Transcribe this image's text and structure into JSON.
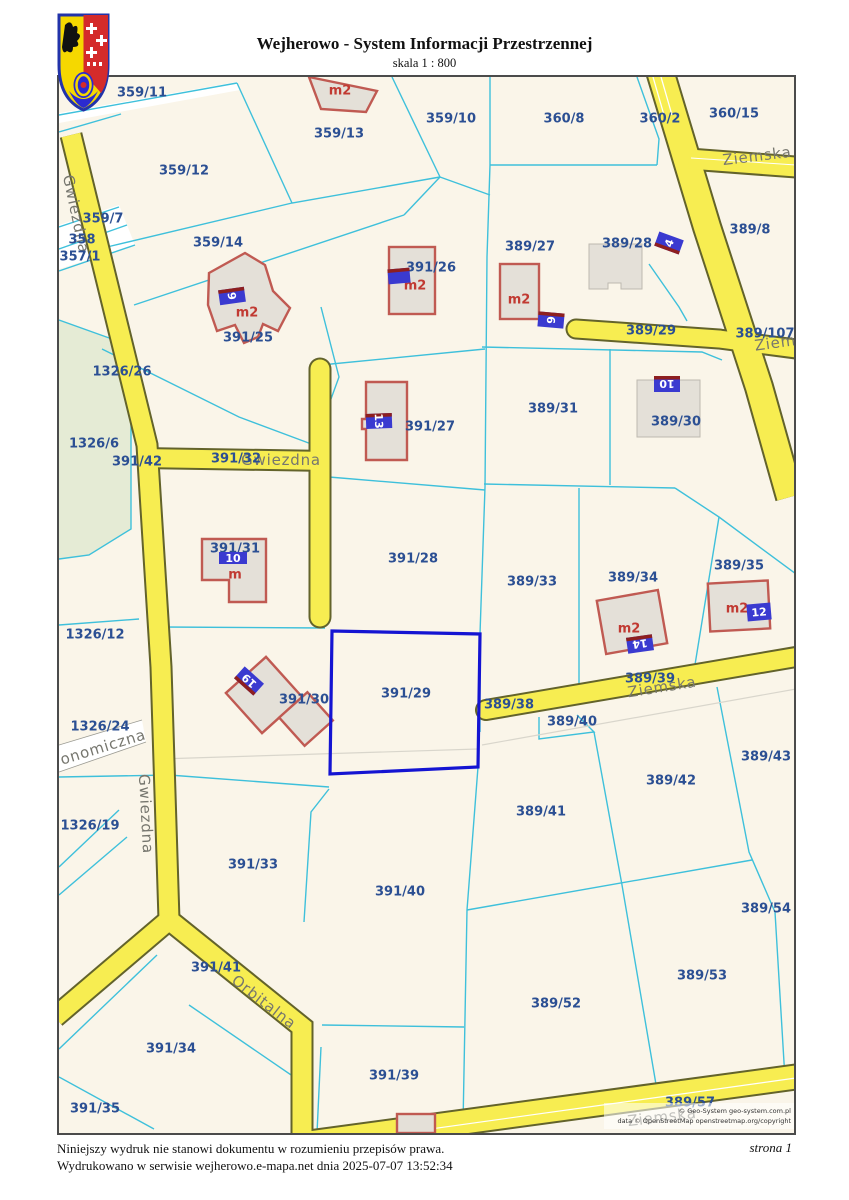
{
  "header": {
    "title": "Wejherowo - System Informacji Przestrzennej",
    "scale": "skala 1 : 800"
  },
  "footer": {
    "disclaimer": "Niniejszy wydruk nie stanowi dokumentu w rozumieniu przepisów prawa.",
    "printed": "Wydrukowano w serwisie wejherowo.e-mapa.net dnia 2025-07-07 13:52:34",
    "page": "strona 1"
  },
  "map": {
    "highlighted_parcel": "391/29",
    "copyright": [
      "© Geo-System geo-system.com.pl",
      "data © OpenStreetMap openstreetmap.org/copyright"
    ],
    "parcel_labels": [
      {
        "t": "359/11",
        "x": 83,
        "y": 15
      },
      {
        "t": "359/13",
        "x": 280,
        "y": 56
      },
      {
        "t": "359/10",
        "x": 392,
        "y": 41
      },
      {
        "t": "360/8",
        "x": 505,
        "y": 41
      },
      {
        "t": "360/2",
        "x": 601,
        "y": 41
      },
      {
        "t": "360/15",
        "x": 675,
        "y": 36
      },
      {
        "t": "359/12",
        "x": 125,
        "y": 93
      },
      {
        "t": "359/7",
        "x": 44,
        "y": 141
      },
      {
        "t": "358",
        "x": 23,
        "y": 162
      },
      {
        "t": "357/1",
        "x": 21,
        "y": 179
      },
      {
        "t": "359/14",
        "x": 159,
        "y": 165
      },
      {
        "t": "389/27",
        "x": 471,
        "y": 169
      },
      {
        "t": "389/28",
        "x": 568,
        "y": 166
      },
      {
        "t": "389/8",
        "x": 691,
        "y": 152
      },
      {
        "t": "391/26",
        "x": 372,
        "y": 190
      },
      {
        "t": "389/29",
        "x": 592,
        "y": 253
      },
      {
        "t": "389/107",
        "x": 706,
        "y": 256
      },
      {
        "t": "391/25",
        "x": 189,
        "y": 260
      },
      {
        "t": "1326/26",
        "x": 63,
        "y": 294
      },
      {
        "t": "389/31",
        "x": 494,
        "y": 331
      },
      {
        "t": "389/30",
        "x": 617,
        "y": 344
      },
      {
        "t": "391/27",
        "x": 371,
        "y": 349
      },
      {
        "t": "1326/6",
        "x": 35,
        "y": 366
      },
      {
        "t": "391/32",
        "x": 177,
        "y": 381
      },
      {
        "t": "391/42",
        "x": 78,
        "y": 384
      },
      {
        "t": "391/31",
        "x": 176,
        "y": 471
      },
      {
        "t": "391/28",
        "x": 354,
        "y": 481
      },
      {
        "t": "389/33",
        "x": 473,
        "y": 504
      },
      {
        "t": "389/34",
        "x": 574,
        "y": 500
      },
      {
        "t": "389/35",
        "x": 680,
        "y": 488
      },
      {
        "t": "1326/12",
        "x": 36,
        "y": 557
      },
      {
        "t": "391/30",
        "x": 245,
        "y": 622
      },
      {
        "t": "391/29",
        "x": 347,
        "y": 616
      },
      {
        "t": "389/38",
        "x": 450,
        "y": 627
      },
      {
        "t": "389/39",
        "x": 591,
        "y": 601
      },
      {
        "t": "389/40",
        "x": 513,
        "y": 644
      },
      {
        "t": "1326/24",
        "x": 41,
        "y": 649
      },
      {
        "t": "389/43",
        "x": 707,
        "y": 679
      },
      {
        "t": "389/42",
        "x": 612,
        "y": 703
      },
      {
        "t": "389/41",
        "x": 482,
        "y": 734
      },
      {
        "t": "1326/19",
        "x": 31,
        "y": 748
      },
      {
        "t": "391/33",
        "x": 194,
        "y": 787
      },
      {
        "t": "391/40",
        "x": 341,
        "y": 814
      },
      {
        "t": "389/54",
        "x": 707,
        "y": 831
      },
      {
        "t": "391/41",
        "x": 157,
        "y": 890
      },
      {
        "t": "389/53",
        "x": 643,
        "y": 898
      },
      {
        "t": "389/52",
        "x": 497,
        "y": 926
      },
      {
        "t": "391/34",
        "x": 112,
        "y": 971
      },
      {
        "t": "391/39",
        "x": 335,
        "y": 998
      },
      {
        "t": "391/35",
        "x": 36,
        "y": 1031
      },
      {
        "t": "389/57",
        "x": 631,
        "y": 1025
      }
    ],
    "street_labels": [
      {
        "t": "Ziemska",
        "x": 698,
        "y": 79,
        "r": -7
      },
      {
        "t": "Ziemska",
        "x": 730,
        "y": 264,
        "r": -8
      },
      {
        "t": "Gwiezdna",
        "x": 17,
        "y": 137,
        "r": 78
      },
      {
        "t": "Gwiezdna",
        "x": 222,
        "y": 383,
        "r": 0
      },
      {
        "t": "Gwiezdna",
        "x": 87,
        "y": 737,
        "r": 87
      },
      {
        "t": "onomiczna",
        "x": 44,
        "y": 670,
        "r": -17
      },
      {
        "t": "Ziemska",
        "x": 603,
        "y": 610,
        "r": -9
      },
      {
        "t": "Orbitalna",
        "x": 205,
        "y": 925,
        "r": 38
      },
      {
        "t": "Ziemska",
        "x": 603,
        "y": 1040,
        "r": -7
      }
    ],
    "address_labels": [
      {
        "t": "9",
        "x": 173,
        "y": 219,
        "r": 82,
        "w": 15,
        "h": 26,
        "s": "left"
      },
      {
        "t": "",
        "x": 340,
        "y": 199,
        "r": 85,
        "w": 15,
        "h": 22,
        "s": "left"
      },
      {
        "t": "6",
        "x": 492,
        "y": 243,
        "r": 95,
        "w": 15,
        "h": 26,
        "s": "left"
      },
      {
        "t": "4",
        "x": 610,
        "y": 166,
        "r": -70,
        "w": 15,
        "h": 26,
        "s": "left"
      },
      {
        "t": "10",
        "x": 608,
        "y": 307,
        "r": 180,
        "w": 26,
        "h": 16,
        "s": "bottom"
      },
      {
        "t": "13",
        "x": 320,
        "y": 344,
        "r": 88,
        "w": 15,
        "h": 26,
        "s": "left"
      },
      {
        "t": "10",
        "x": 174,
        "y": 481,
        "r": 0,
        "w": 28,
        "h": 12,
        "s": "none"
      },
      {
        "t": "19",
        "x": 190,
        "y": 604,
        "r": -138,
        "w": 26,
        "h": 16,
        "s": "top"
      },
      {
        "t": "14",
        "x": 581,
        "y": 567,
        "r": 172,
        "w": 26,
        "h": 16,
        "s": "bottom"
      },
      {
        "t": "12",
        "x": 700,
        "y": 535,
        "r": -5,
        "w": 24,
        "h": 17,
        "s": "none"
      }
    ],
    "building_labels": [
      {
        "t": "m2",
        "x": 281,
        "y": 13
      },
      {
        "t": "m2",
        "x": 188,
        "y": 235
      },
      {
        "t": "m2",
        "x": 356,
        "y": 208
      },
      {
        "t": "m2",
        "x": 460,
        "y": 222
      },
      {
        "t": "m2",
        "x": 570,
        "y": 551
      },
      {
        "t": "m2",
        "x": 678,
        "y": 531
      },
      {
        "t": "m",
        "x": 176,
        "y": 497
      }
    ],
    "colors": {
      "parcel_line": "#3EC0DB",
      "road_fill": "#F7ED51",
      "road_casing": "#63632B",
      "highlight": "#1414D2",
      "building_stroke": "#C05A52",
      "building_fill": "#E4E0D8",
      "parcel_text": "#2B4F93",
      "street_text": "#76766E",
      "address_bg": "#3A3AD0",
      "address_stripe": "#8E1F1F",
      "m2_text": "#C13A32",
      "green_area": "#E5EBD5",
      "map_bg": "#FAF5E9"
    }
  }
}
